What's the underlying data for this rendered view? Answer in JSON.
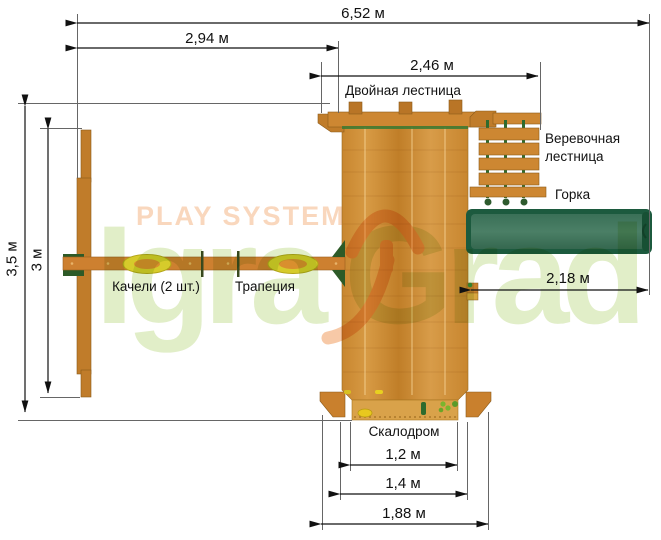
{
  "diagram": {
    "type": "playground-top-view-plan",
    "dimensions": {
      "total_width": "6,52 м",
      "swing_span": "2,94 м",
      "double_ladder_width": "2,46 м",
      "total_depth": "3,5 м",
      "swing_beam_depth": "3 м",
      "slide_length": "2,18 м",
      "climbing_wall_inner": "1,2 м",
      "climbing_wall_outer": "1,4 м",
      "base_width": "1,88 м"
    },
    "labels": {
      "double_ladder": "Двойная лестница",
      "rope_ladder_line1": "Веревочная",
      "rope_ladder_line2": "лестница",
      "slide": "Горка",
      "swings": "Качели (2 шт.)",
      "trapeze": "Трапеция",
      "climbing_wall": "Скалодром"
    },
    "watermark": {
      "brand_top": "PLAY SYSTEM",
      "brand_left": "Igra",
      "brand_right": "Grad"
    },
    "colors": {
      "wood": "#cd8732",
      "wood_dark": "#b97526",
      "wood_light": "#d9a24a",
      "slide_green_dark": "#1c5a3e",
      "slide_green": "#477a61",
      "rope_green": "#2e6b2e",
      "bracket_green": "#2d5a27",
      "seat_yellow": "#d6cb2b",
      "dimension_line": "#1a1a1a",
      "watermark_orange": "#f6bf94",
      "watermark_green": "#cfe3a6"
    }
  }
}
